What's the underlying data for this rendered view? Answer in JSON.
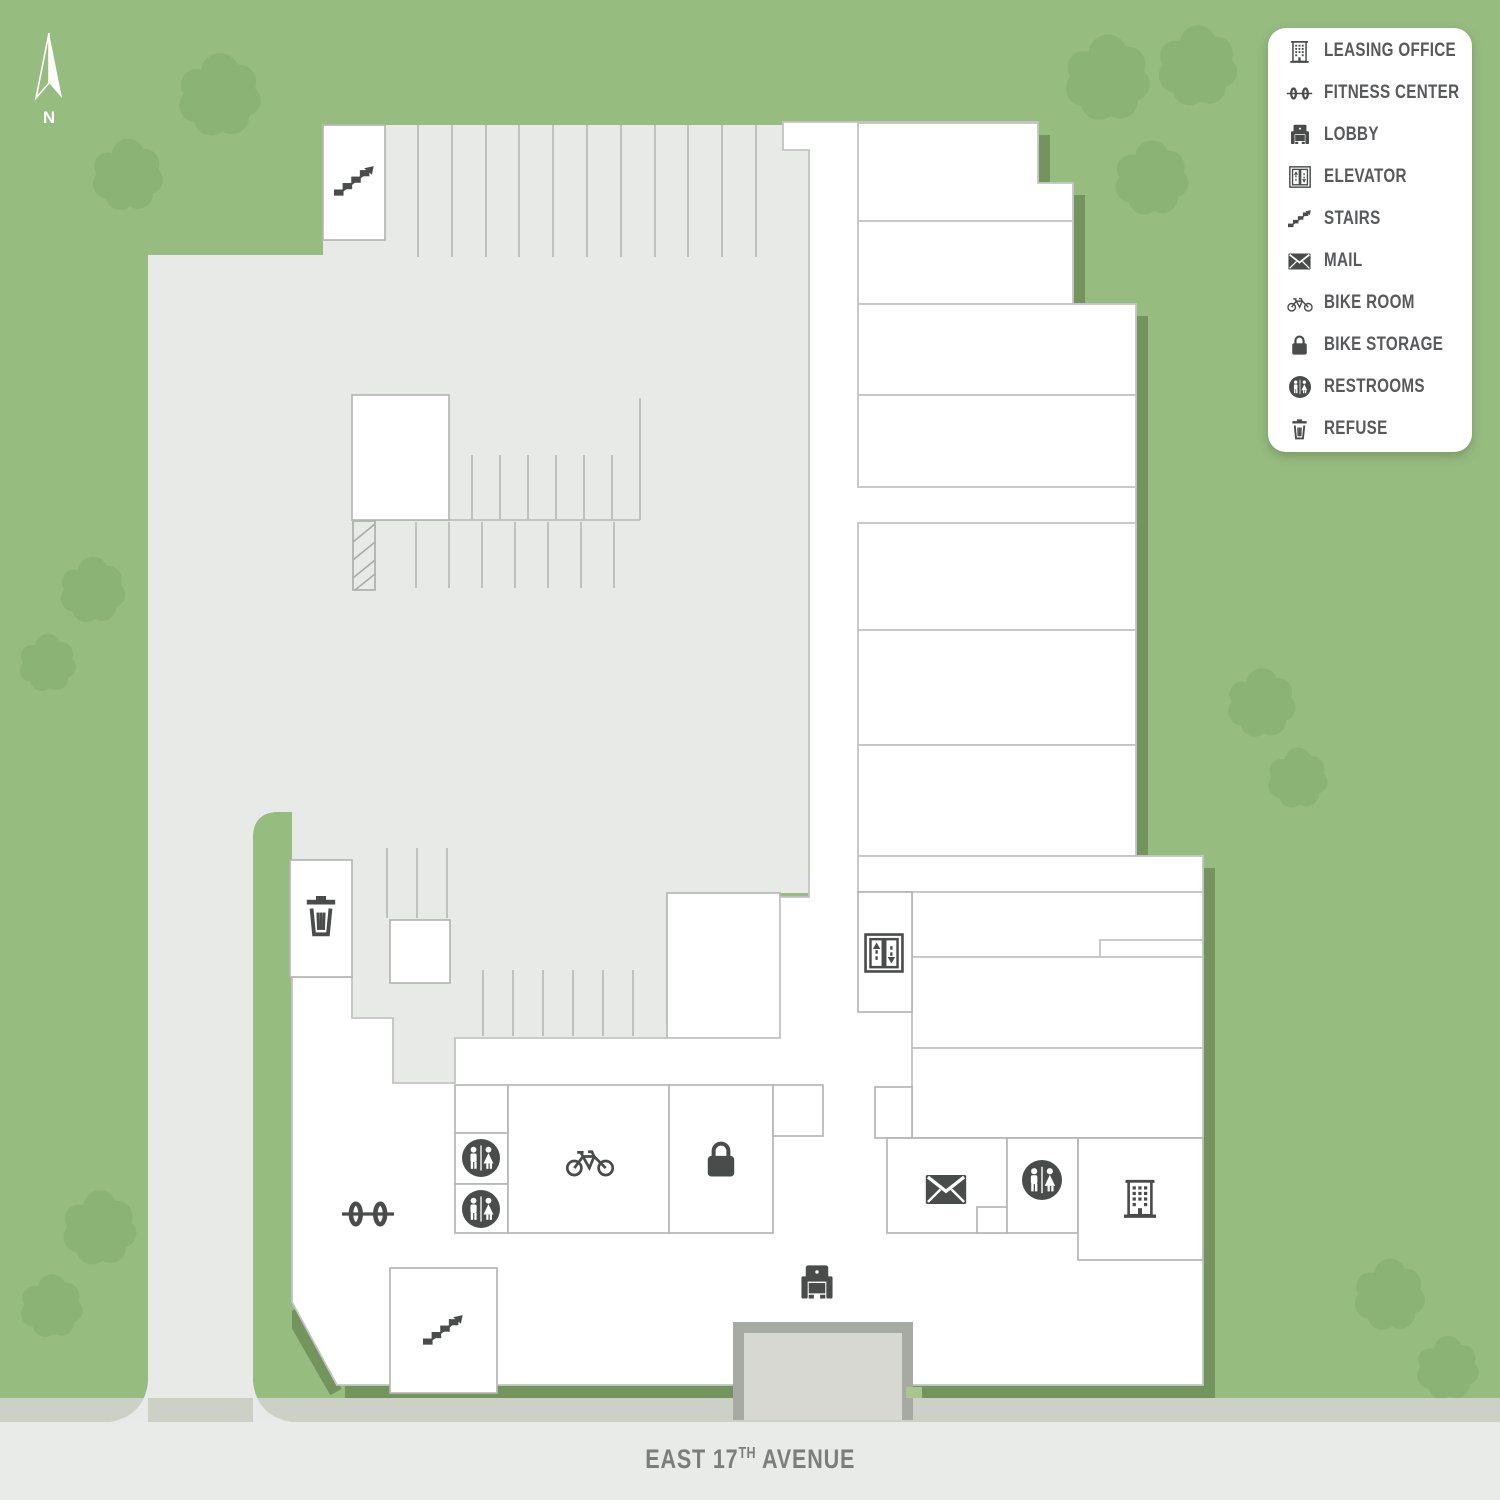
{
  "compass": {
    "label": "N"
  },
  "street": {
    "name_prefix": "EAST 17",
    "superscript": "TH",
    "name_suffix": " AVENUE"
  },
  "legend": {
    "items": [
      {
        "icon": "leasing-office-icon",
        "label": "LEASING OFFICE"
      },
      {
        "icon": "fitness-center-icon",
        "label": "FITNESS CENTER"
      },
      {
        "icon": "lobby-icon",
        "label": "LOBBY"
      },
      {
        "icon": "elevator-icon",
        "label": "ELEVATOR"
      },
      {
        "icon": "stairs-icon",
        "label": "STAIRS"
      },
      {
        "icon": "mail-icon",
        "label": "MAIL"
      },
      {
        "icon": "bike-room-icon",
        "label": "BIKE ROOM"
      },
      {
        "icon": "bike-storage-icon",
        "label": "BIKE STORAGE"
      },
      {
        "icon": "restrooms-icon",
        "label": "RESTROOMS"
      },
      {
        "icon": "refuse-icon",
        "label": "REFUSE"
      }
    ]
  },
  "map_icons": [
    "stairs-icon@parking-north",
    "refuse-icon",
    "elevator-icon",
    "mail-icon",
    "restrooms-icon@east-wing",
    "leasing-office-icon",
    "restrooms-icon@bike-hall-upper",
    "restrooms-icon@bike-hall-lower",
    "bike-room-icon",
    "bike-storage-icon",
    "fitness-center-icon",
    "lobby-icon",
    "stairs-icon@south-lobby"
  ],
  "colors": {
    "grass": "#96bc80",
    "tree": "#8bb375",
    "building_shadow": "#73955d",
    "pavement": "#e8eae8",
    "street": "#e9ebe8",
    "sidewalk": "#cdd0c7",
    "walls": "#c2c5c2",
    "icons": "#4a4b4b",
    "legend_text": "#58595b",
    "street_text": "#7b7e79"
  }
}
